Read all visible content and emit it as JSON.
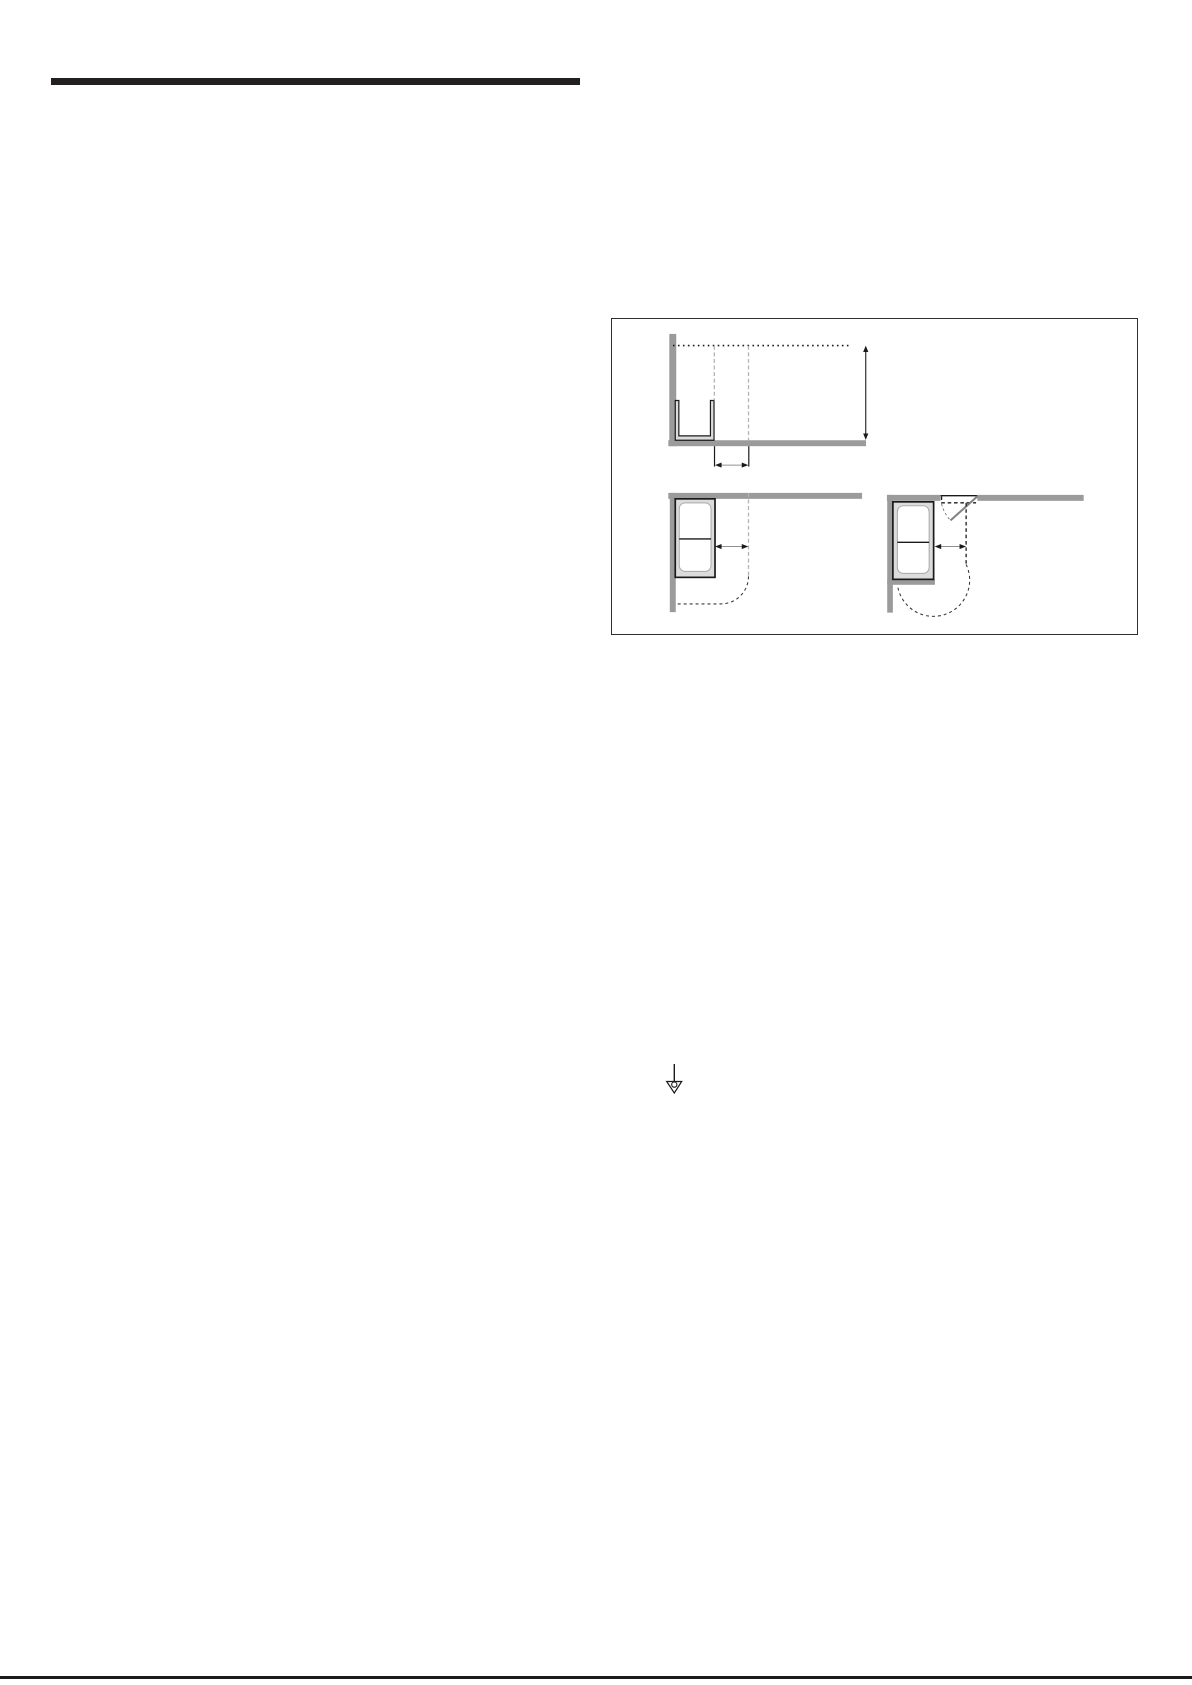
{
  "page": {
    "type": "manual-page",
    "visible_text": "",
    "background": "#ffffff"
  },
  "header": {
    "bar_color": "#231f20"
  },
  "footer": {
    "rule_color": "#1a1a1a"
  },
  "colors": {
    "bar_black": "#231f20",
    "rule_black": "#1a1a1a",
    "panel_border": "#2e2e2e",
    "wall_gray": "#9b9b9b",
    "speaker_fill": "#dcdcdc",
    "outline_black": "#1a1a1a",
    "inner_outline_gray": "#a8a8a8",
    "dash_light_gray": "#b4b4b4",
    "dash_dark": "#3a3a3a",
    "door_gray": "#808080",
    "dim_gray": "#909090",
    "page_bg": "#ffffff"
  },
  "icons": {
    "ground_symbol": "earth-ground-icon"
  },
  "diagram_panel": {
    "figures": [
      "front-view-wall-clearance-with-bracket",
      "top-view-corner-placement-left",
      "top-view-corner-placement-right-with-niche-door"
    ]
  }
}
